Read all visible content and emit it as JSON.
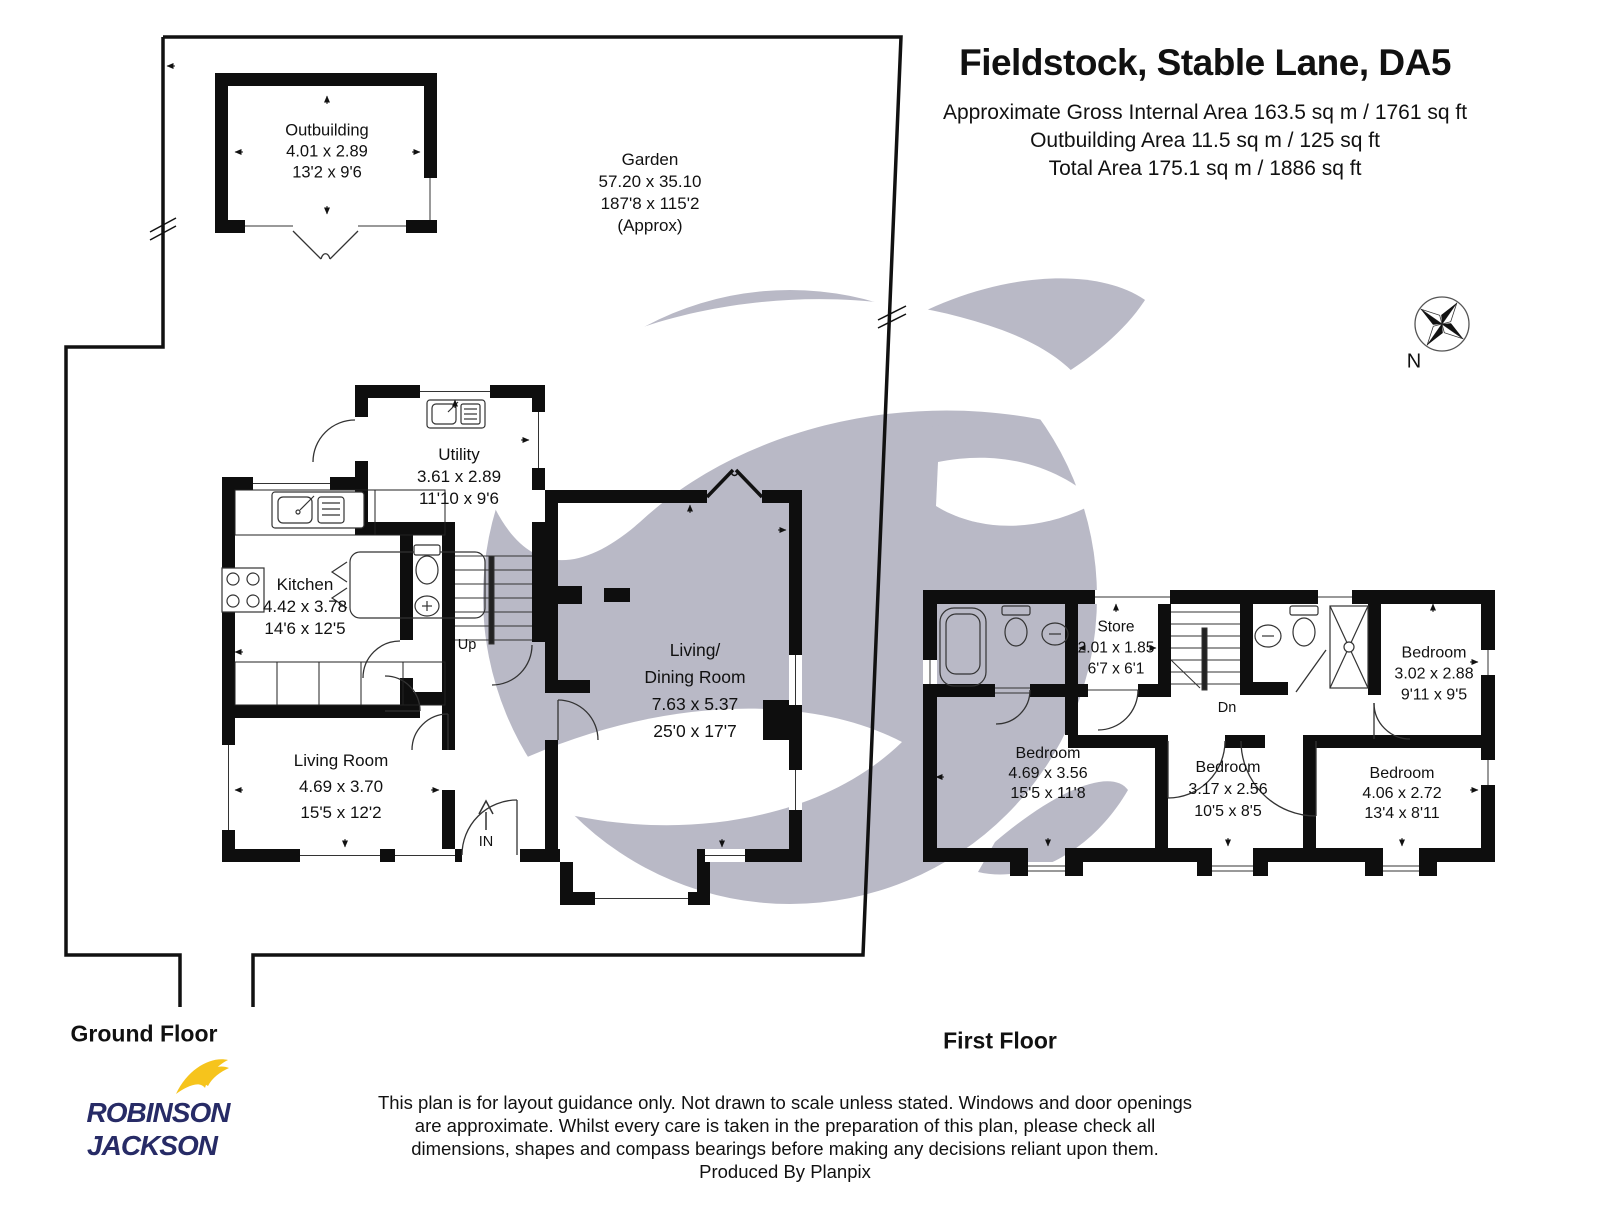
{
  "header": {
    "title": "Fieldstock, Stable Lane, DA5",
    "area_line1": "Approximate Gross Internal Area 163.5 sq m / 1761 sq ft",
    "area_line2": "Outbuilding Area 11.5 sq m / 125 sq ft",
    "area_line3": "Total Area 175.1 sq m / 1886 sq ft"
  },
  "compass": {
    "north_label": "N"
  },
  "floor_labels": {
    "ground": "Ground Floor",
    "first": "First Floor"
  },
  "garden": {
    "name": "Garden",
    "metric": "57.20 x 35.10",
    "imperial": "187'8 x 115'2",
    "note": "(Approx)"
  },
  "rooms": {
    "outbuilding": {
      "name": "Outbuilding",
      "metric": "4.01 x 2.89",
      "imperial": "13'2 x 9'6"
    },
    "utility": {
      "name": "Utility",
      "metric": "3.61 x 2.89",
      "imperial": "11'10 x 9'6"
    },
    "kitchen": {
      "name": "Kitchen",
      "metric": "4.42 x 3.78",
      "imperial": "14'6 x 12'5"
    },
    "living_room": {
      "name": "Living Room",
      "metric": "4.69 x 3.70",
      "imperial": "15'5 x 12'2"
    },
    "living_dining": {
      "name_line1": "Living/",
      "name_line2": "Dining Room",
      "metric": "7.63 x 5.37",
      "imperial": "25'0 x 17'7"
    },
    "store": {
      "name": "Store",
      "metric": "2.01 x 1.85",
      "imperial": "6'7 x 6'1"
    },
    "bedroom_main": {
      "name": "Bedroom",
      "metric": "4.69 x 3.56",
      "imperial": "15'5 x 11'8"
    },
    "bedroom_middle": {
      "name": "Bedroom",
      "metric": "3.17 x 2.56",
      "imperial": "10'5 x 8'5"
    },
    "bedroom_top_right": {
      "name": "Bedroom",
      "metric": "3.02 x 2.88",
      "imperial": "9'11 x 9'5"
    },
    "bedroom_bot_right": {
      "name": "Bedroom",
      "metric": "4.06 x 2.72",
      "imperial": "13'4 x 8'11"
    }
  },
  "markers": {
    "stairs_up": "Up",
    "stairs_down": "Dn",
    "entrance": "IN"
  },
  "footer": {
    "line1": "This plan is for layout guidance only. Not drawn to scale unless stated. Windows and door openings",
    "line2": "are approximate. Whilst every care is taken in the preparation of this plan, please check all",
    "line3": "dimensions, shapes and compass bearings before making any decisions reliant upon them.",
    "line4": "Produced By Planpix"
  },
  "logo": {
    "line1": "ROBINSON",
    "line2": "JACKSON"
  },
  "colors": {
    "wall": "#0e0e0e",
    "watermark": "#b9b9c6",
    "logo_navy": "#272b66",
    "logo_yellow": "#f6c41c"
  }
}
